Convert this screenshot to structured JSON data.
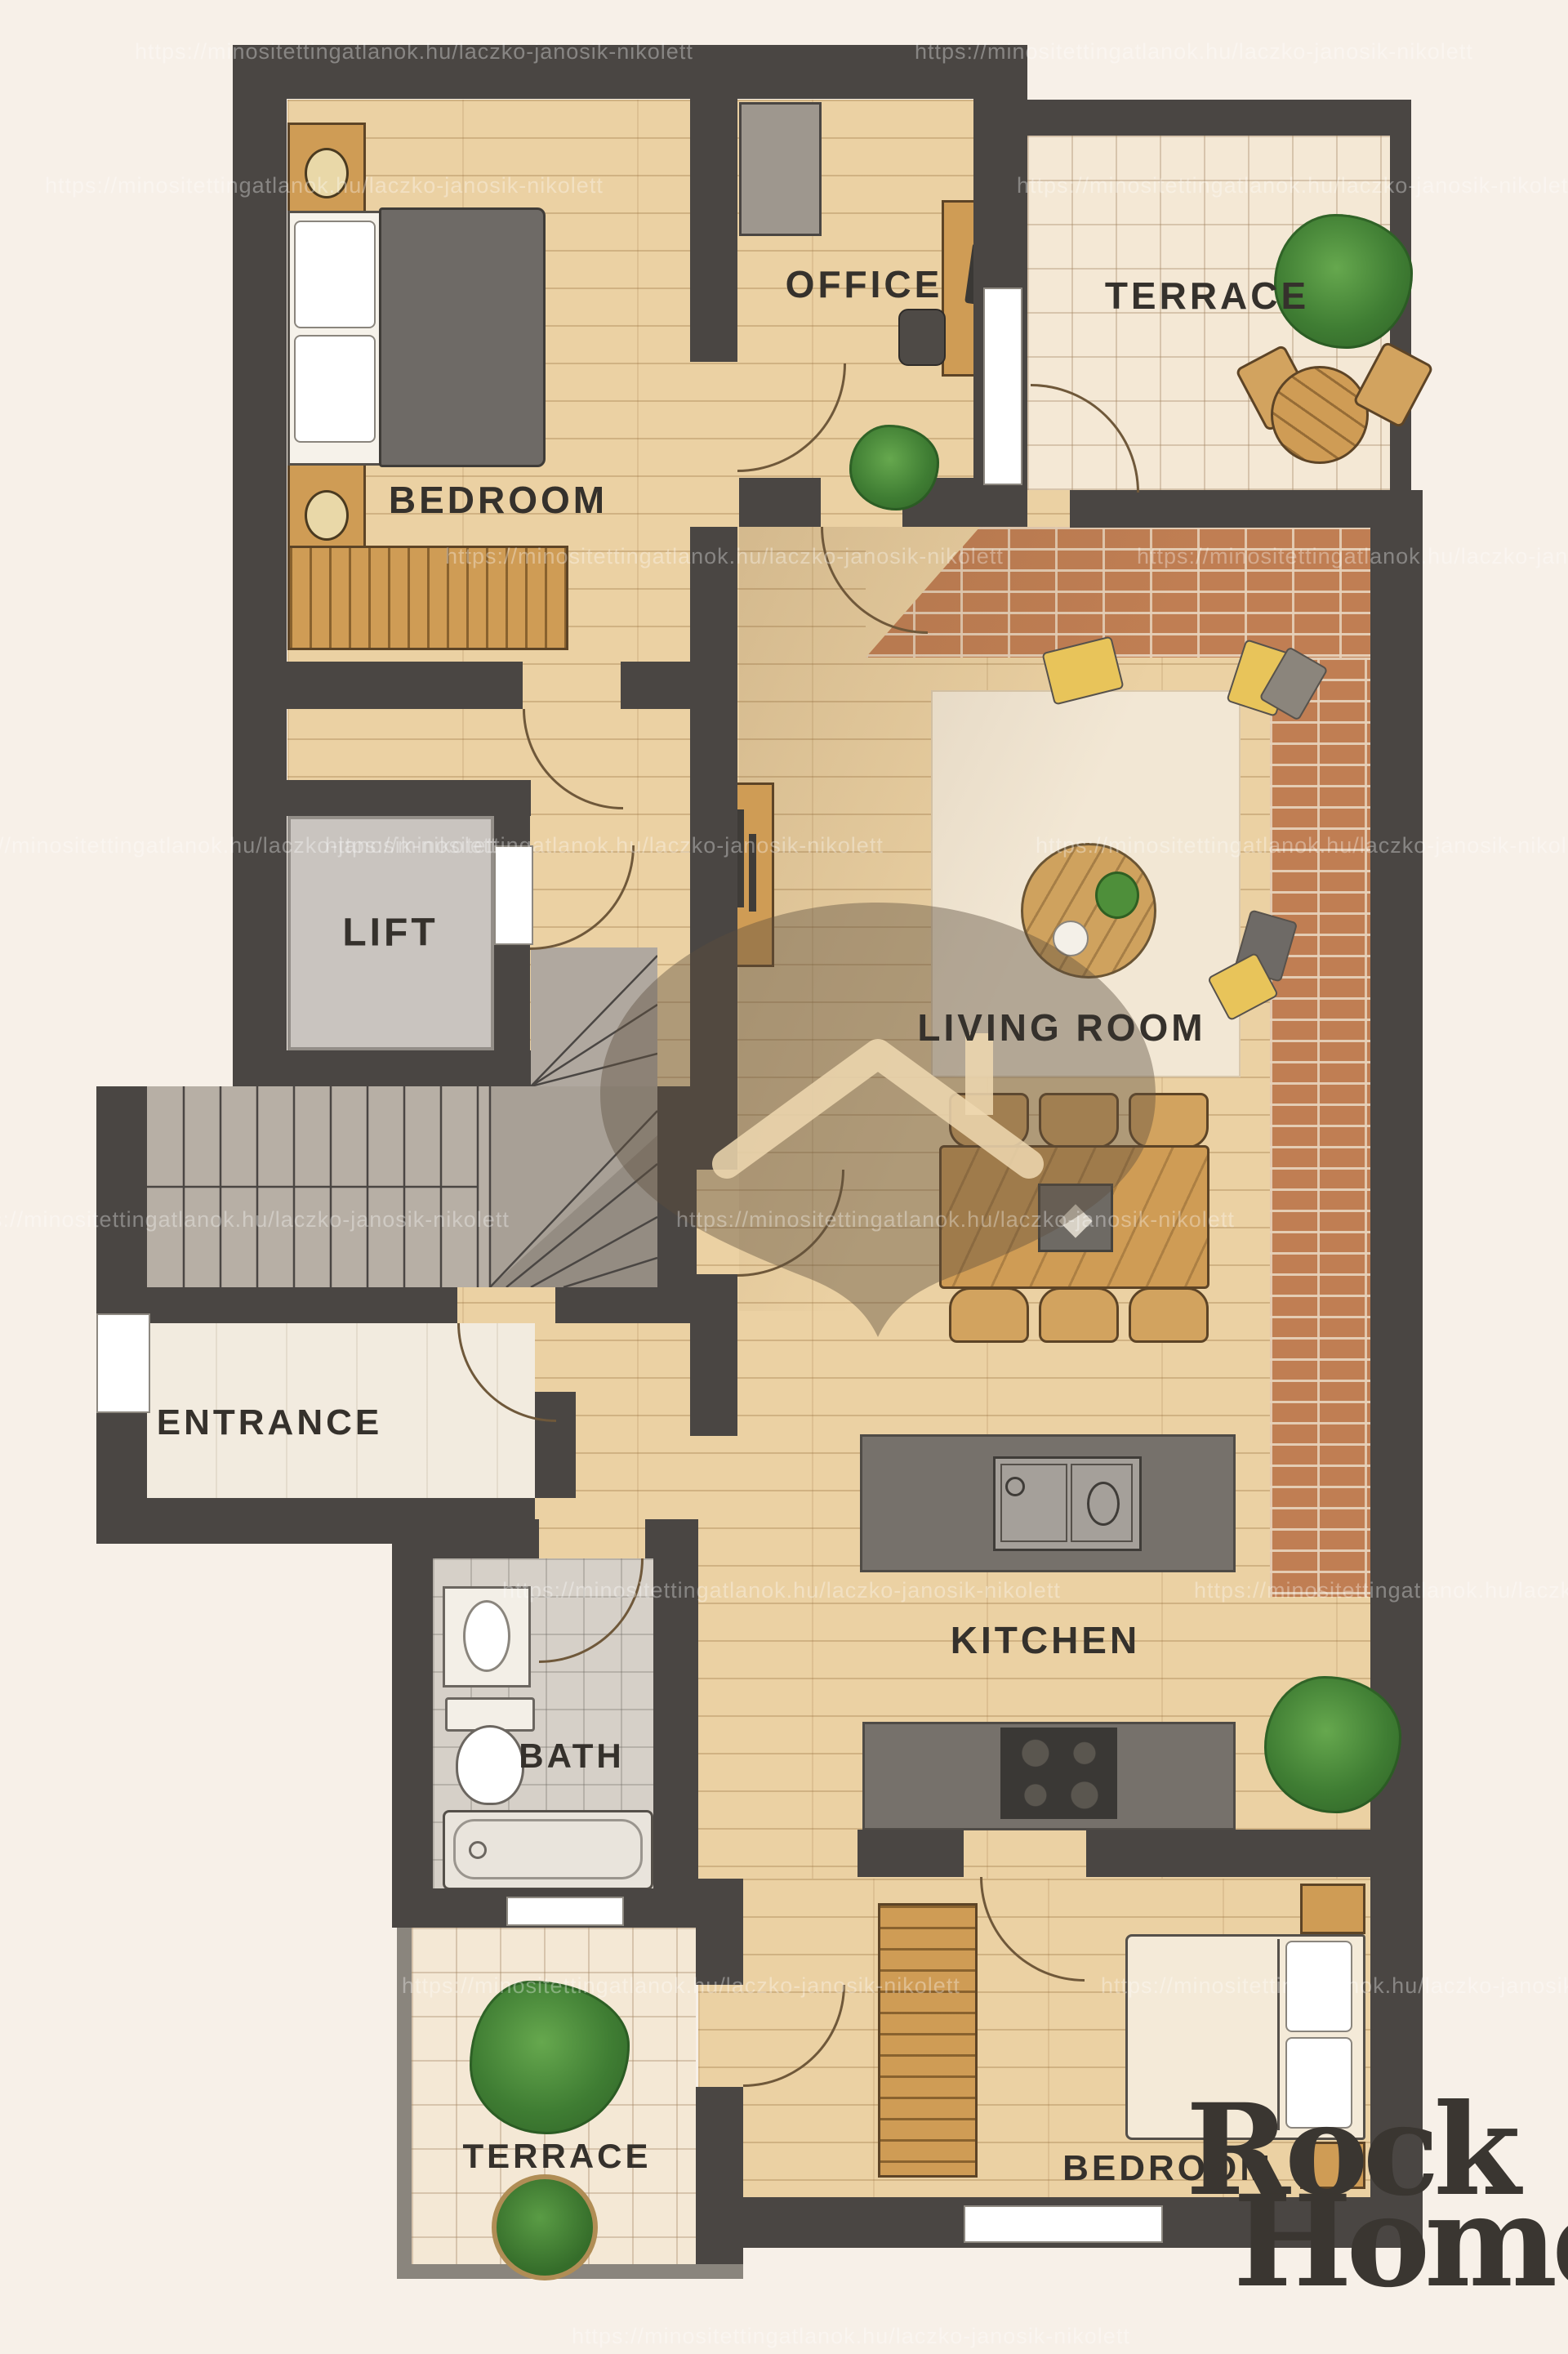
{
  "branding": {
    "logo_line1": "Rock",
    "logo_line2": "Home"
  },
  "watermark": {
    "text": "https://minositettingatlanok.hu/laczko-janosik-nikolett"
  },
  "rooms": {
    "bedroom1": {
      "label": "BEDROOM"
    },
    "office": {
      "label": "OFFICE"
    },
    "terrace_top": {
      "label": "TERRACE"
    },
    "living_room": {
      "label": "LIVING ROOM"
    },
    "lift": {
      "label": "LIFT"
    },
    "entrance": {
      "label": "ENTRANCE"
    },
    "kitchen": {
      "label": "KITCHEN"
    },
    "bath": {
      "label": "BATH"
    },
    "bedroom2": {
      "label": "BEDROOM"
    },
    "terrace_bottom": {
      "label": "TERRACE"
    }
  },
  "palette": {
    "background": "#f7f0e8",
    "wall": "#4a4643",
    "wood_floor": "#ebd1a3",
    "wood_furniture": "#cf9c55",
    "brick": "#c07e53",
    "terrace_tile": "#f4e8d5",
    "bath_tile": "#d6d0c8",
    "lift_gray": "#c9c4bf",
    "plant_green": "#3f7d33",
    "label_text": "#35312c",
    "logo_text": "#3a3631"
  }
}
